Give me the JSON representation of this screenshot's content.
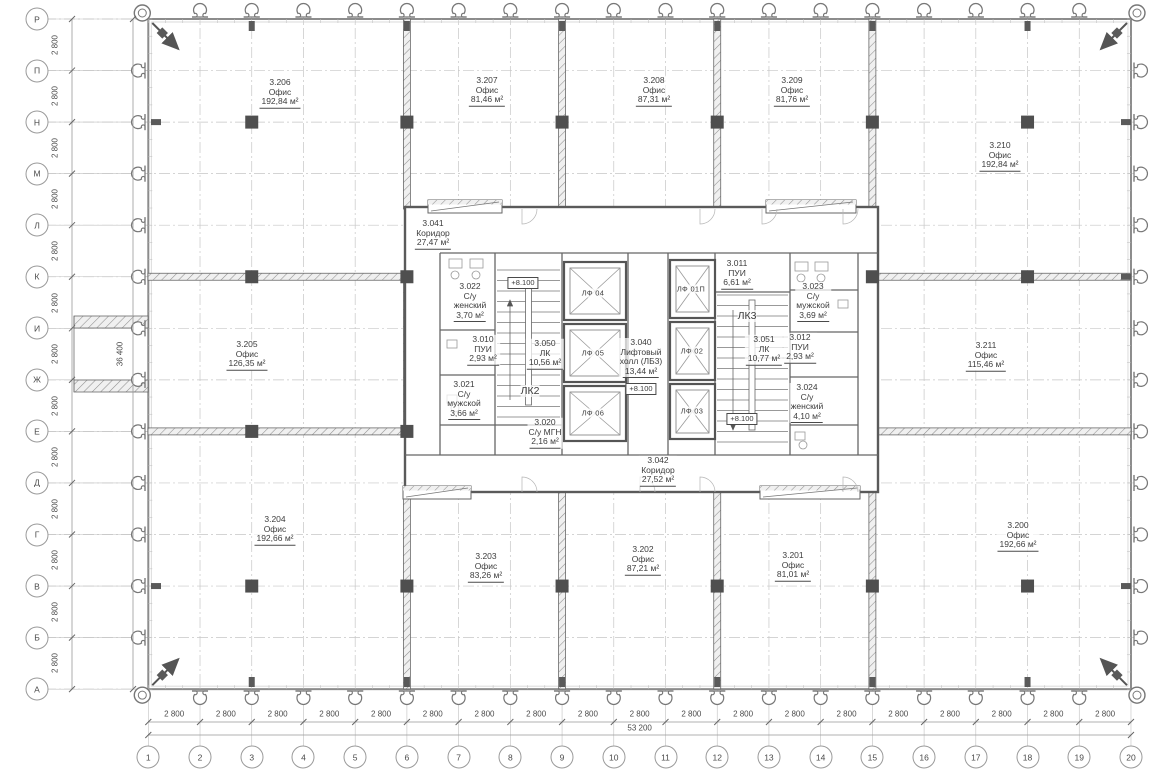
{
  "drawing": {
    "type": "architectural-floor-plan",
    "language": "ru",
    "colors": {
      "paper": "#ffffff",
      "facade_line": "#8c8c8c",
      "wall_line": "#5a5a5a",
      "grid_line": "#c6c6c6",
      "text": "#3d3d3d",
      "column_fill": "#4f4f4f"
    },
    "grid": {
      "columns": [
        "1",
        "2",
        "3",
        "4",
        "5",
        "6",
        "7",
        "8",
        "9",
        "10",
        "11",
        "12",
        "13",
        "14",
        "15",
        "16",
        "17",
        "18",
        "19",
        "20"
      ],
      "rows": [
        "Р",
        "П",
        "Н",
        "М",
        "Л",
        "К",
        "И",
        "Ж",
        "Е",
        "Д",
        "Г",
        "В",
        "Б",
        "А"
      ],
      "column_spacing_label": "2 800",
      "row_spacing_label": "2 800",
      "total_width_label": "53 200",
      "total_height_label": "36 400"
    },
    "rooms": [
      {
        "id": "3.206",
        "name": [
          "Офис"
        ],
        "area": "192,84 м²",
        "x": 280,
        "y": 93
      },
      {
        "id": "3.207",
        "name": [
          "Офис"
        ],
        "area": "81,46 м²",
        "x": 487,
        "y": 91
      },
      {
        "id": "3.208",
        "name": [
          "Офис"
        ],
        "area": "87,31 м²",
        "x": 654,
        "y": 91
      },
      {
        "id": "3.209",
        "name": [
          "Офис"
        ],
        "area": "81,76 м²",
        "x": 792,
        "y": 91
      },
      {
        "id": "3.210",
        "name": [
          "Офис"
        ],
        "area": "192,84 м²",
        "x": 1000,
        "y": 156
      },
      {
        "id": "3.205",
        "name": [
          "Офис"
        ],
        "area": "126,35 м²",
        "x": 247,
        "y": 355
      },
      {
        "id": "3.211",
        "name": [
          "Офис"
        ],
        "area": "115,46 м²",
        "x": 986,
        "y": 356
      },
      {
        "id": "3.204",
        "name": [
          "Офис"
        ],
        "area": "192,66 м²",
        "x": 275,
        "y": 530
      },
      {
        "id": "3.203",
        "name": [
          "Офис"
        ],
        "area": "83,26 м²",
        "x": 486,
        "y": 567
      },
      {
        "id": "3.202",
        "name": [
          "Офис"
        ],
        "area": "87,21 м²",
        "x": 643,
        "y": 560
      },
      {
        "id": "3.201",
        "name": [
          "Офис"
        ],
        "area": "81,01 м²",
        "x": 793,
        "y": 566
      },
      {
        "id": "3.200",
        "name": [
          "Офис"
        ],
        "area": "192,66 м²",
        "x": 1018,
        "y": 536
      },
      {
        "id": "3.041",
        "name": [
          "Коридор"
        ],
        "area": "27,47 м²",
        "x": 433,
        "y": 234
      },
      {
        "id": "3.042",
        "name": [
          "Коридор"
        ],
        "area": "27,52 м²",
        "x": 658,
        "y": 471
      },
      {
        "id": "3.022",
        "name": [
          "С/у",
          "женский"
        ],
        "area": "3,70 м²",
        "x": 470,
        "y": 302
      },
      {
        "id": "3.010",
        "name": [
          "ПУИ"
        ],
        "area": "2,93 м²",
        "x": 483,
        "y": 350
      },
      {
        "id": "3.050",
        "name": [
          "ЛК"
        ],
        "area": "10,56 м²",
        "x": 545,
        "y": 354
      },
      {
        "id": "3.021",
        "name": [
          "С/у",
          "мужской"
        ],
        "area": "3,66 м²",
        "x": 464,
        "y": 400
      },
      {
        "id": "3.020",
        "name": [
          "С/у МГН"
        ],
        "area": "2,16 м²",
        "x": 545,
        "y": 433
      },
      {
        "id": "3.040",
        "name": [
          "Лифтовый",
          "холл (ЛБ3)"
        ],
        "area": "13,44 м²",
        "x": 641,
        "y": 358
      },
      {
        "id": "3.011",
        "name": [
          "ПУИ"
        ],
        "area": "6,61 м²",
        "x": 737,
        "y": 274
      },
      {
        "id": "3.023",
        "name": [
          "С/у",
          "мужской"
        ],
        "area": "3,69 м²",
        "x": 813,
        "y": 302
      },
      {
        "id": "3.051",
        "name": [
          "ЛК"
        ],
        "area": "10,77 м²",
        "x": 764,
        "y": 350
      },
      {
        "id": "3.012",
        "name": [
          "ПУИ"
        ],
        "area": "2,93 м²",
        "x": 800,
        "y": 348
      },
      {
        "id": "3.024",
        "name": [
          "С/у",
          "женский"
        ],
        "area": "4,10 м²",
        "x": 807,
        "y": 403
      }
    ],
    "stairs": [
      {
        "label": "ЛК2",
        "x": 530,
        "y": 391
      },
      {
        "label": "ЛК3",
        "x": 747,
        "y": 316
      }
    ],
    "elevators": [
      {
        "label": "ЛФ 04",
        "x": 593,
        "y": 293
      },
      {
        "label": "ЛФ 05",
        "x": 593,
        "y": 353
      },
      {
        "label": "ЛФ 06",
        "x": 593,
        "y": 413
      },
      {
        "label": "ЛФ 01П",
        "x": 691,
        "y": 289
      },
      {
        "label": "ЛФ 02",
        "x": 692,
        "y": 351
      },
      {
        "label": "ЛФ 03",
        "x": 692,
        "y": 411
      }
    ],
    "elevation_marks": [
      {
        "text": "+8.100",
        "x": 523,
        "y": 283
      },
      {
        "text": "+8.100",
        "x": 641,
        "y": 389
      },
      {
        "text": "+8.100",
        "x": 742,
        "y": 419
      }
    ],
    "symbols": {
      "facade_anchor": "omega-anchor-icon",
      "corner_anchor": "omega-anchor-arrow-icon",
      "column_marker": "filled-square",
      "interior_wall": "diagonal-hatch"
    }
  }
}
